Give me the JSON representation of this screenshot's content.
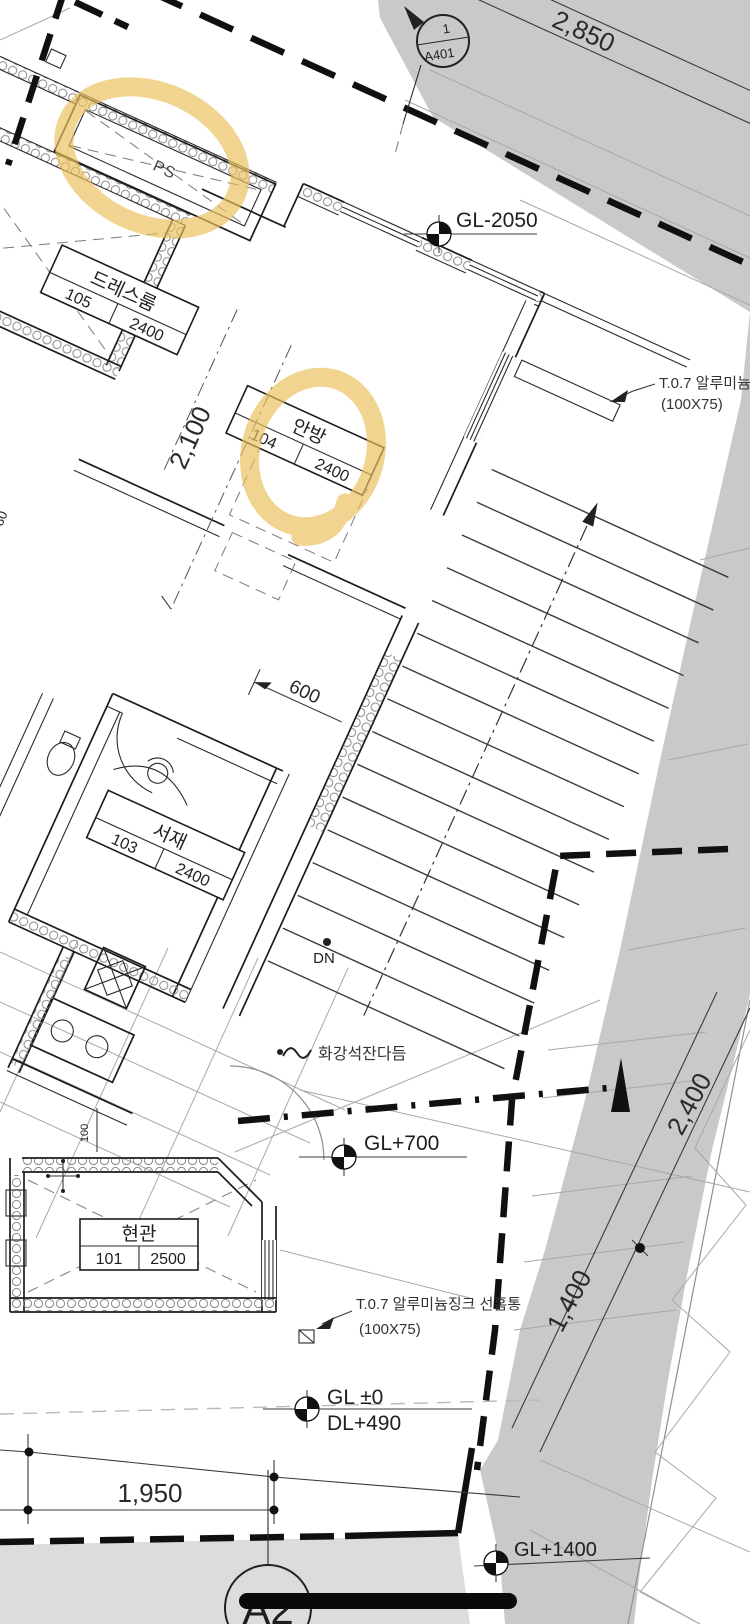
{
  "drawing": {
    "section_marker": {
      "top": "1",
      "bottom": "A401"
    },
    "grid_bubble": "A2",
    "shaft_label": "PS",
    "stair_label": "DN",
    "finish_note": "화강석잔다듬",
    "notes": {
      "right": {
        "line1": "T.0.7 알루미늄징크",
        "line2": "(100X75)"
      },
      "downspout": {
        "line1": "T.0.7 알루미늄징크 선홈통",
        "line2": "(100X75)"
      }
    },
    "rooms": {
      "dressroom": {
        "name": "드레스룸",
        "number": "105",
        "ceiling": "2400"
      },
      "master": {
        "name": "안방",
        "number": "104",
        "ceiling": "2400"
      },
      "study": {
        "name": "서재",
        "number": "103",
        "ceiling": "2400"
      },
      "entrance": {
        "name": "현관",
        "number": "101",
        "ceiling": "2500"
      }
    },
    "levels": {
      "gl_m2050": "GL-2050",
      "gl_p700": "GL+700",
      "gl_0": "GL ±0",
      "dl_490": "DL+490",
      "gl_p1400": "GL+1400"
    },
    "dims": {
      "top": "2,850",
      "master_left": "2,100",
      "small_left": "80",
      "stair": "600",
      "site_upper": "2,400",
      "site_lower": "1,400",
      "bottom": "1,950",
      "wall": "100"
    }
  },
  "colors": {
    "highlight": "#e9c05a",
    "terrain": "#c9c9c9",
    "terrain_light": "#dcdcdc",
    "line": "#1c1c1c"
  }
}
